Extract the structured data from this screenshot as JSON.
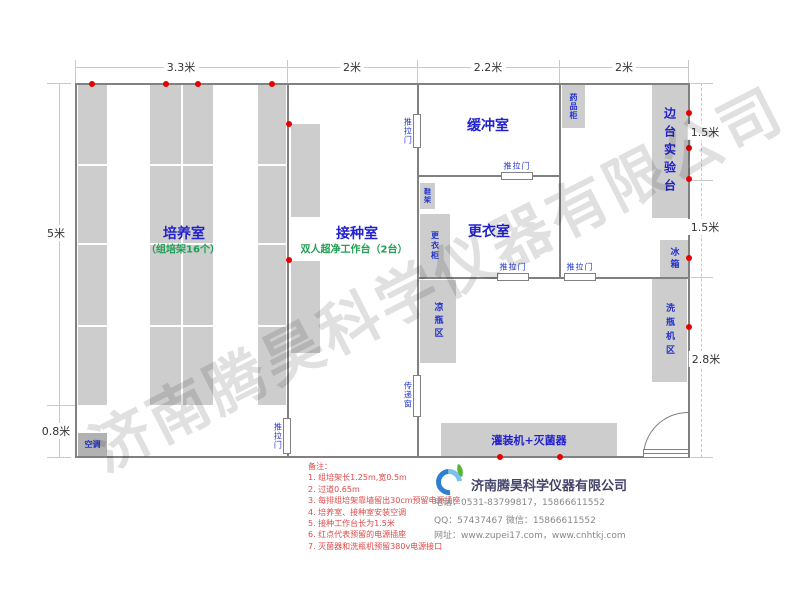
{
  "watermark": {
    "text": "济南腾昊科学仪器有限公司"
  },
  "dimensions": {
    "top": [
      "3.3米",
      "2米",
      "2.2米",
      "2米"
    ],
    "left": [
      "5米",
      "0.8米"
    ],
    "right": [
      "1.5米",
      "1.5米",
      "2.8米"
    ]
  },
  "rooms": {
    "culture": {
      "title": "培养室",
      "subtitle": "（组培架16个）"
    },
    "inoculation": {
      "title": "接种室",
      "subtitle": "双人超净工作台（2台）"
    },
    "buffer": {
      "title": "缓冲室"
    },
    "changing": {
      "title": "更衣室"
    }
  },
  "labels": {
    "sliding_door": "推拉门",
    "transfer_window": "传递窗",
    "shoe_rack": "鞋架",
    "wardrobe": "更衣柜",
    "cooling_area": "凉瓶区",
    "medicine_cabinet": "药品柜",
    "side_bench": "边台实验台",
    "fridge": "冰箱",
    "washer_area": "洗瓶机区",
    "air_conditioner": "空调",
    "filling_sterilizer": "灌装机+灭菌器"
  },
  "notes": {
    "heading": "备注：",
    "items": [
      "1. 组培架长1.25m,宽0.5m",
      "2. 过道0.65m",
      "3. 每排组培架靠墙留出30cm预留电源插座",
      "4. 培养室、接种室安装空调",
      "5. 接种工作台长为1.5米",
      "6. 红点代表预留的电源插座",
      "7. 灭菌器和洗瓶机预留380v电源接口"
    ]
  },
  "footer": {
    "company": "济南腾昊科学仪器有限公司",
    "phone": "电话：0531-83799817，15866611552",
    "qq": "QQ：57437467    微信：15866611552",
    "website": "网址：www.zupei17.com，www.cnhtkj.com"
  },
  "colors": {
    "wall": "#818181",
    "furniture_fill": "#cdcdcd",
    "label_blue": "#2222cc",
    "label_green": "#1fa052",
    "outlet_red": "#e60000",
    "notes_red": "#e04848"
  }
}
